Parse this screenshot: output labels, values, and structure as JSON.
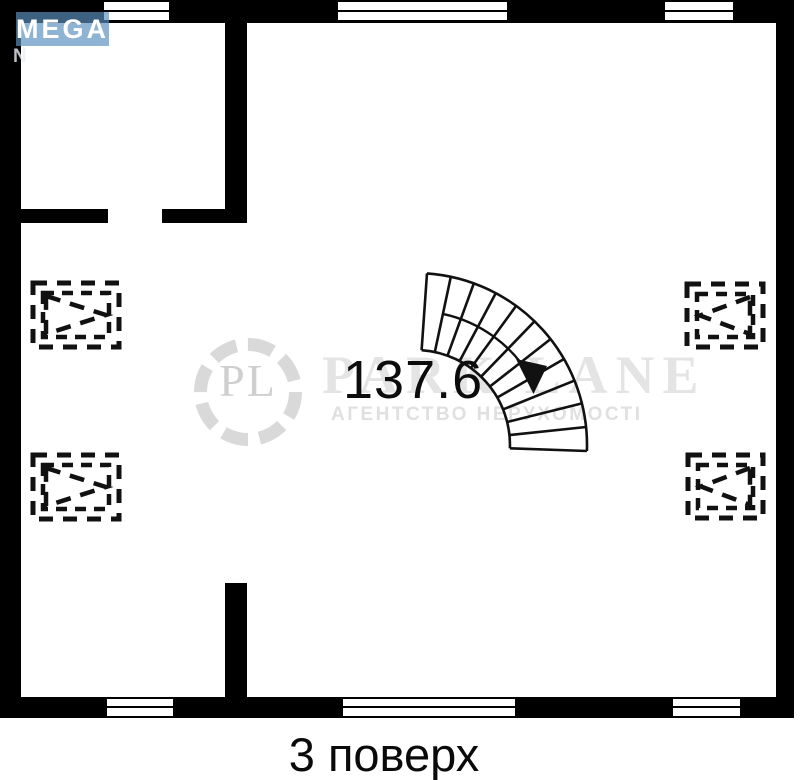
{
  "mega_logo": {
    "text": "MEGA",
    "partial_second_line": "N",
    "bg_color": "#5a91be",
    "text_color": "#ffffff"
  },
  "parklane_watermark": {
    "monogram": "PL",
    "title": "PARK LANE",
    "subtitle": "АГЕНТСТВО НЕРУХОМОСТІ",
    "color": "#dcdcdc"
  },
  "plan": {
    "area_value": "137.6"
  },
  "caption": {
    "text": "3 поверх"
  },
  "colors": {
    "wall": "#000000",
    "background": "#ffffff",
    "watermark_gray": "#dcdcdc",
    "mega_blue": "#5a91be"
  }
}
